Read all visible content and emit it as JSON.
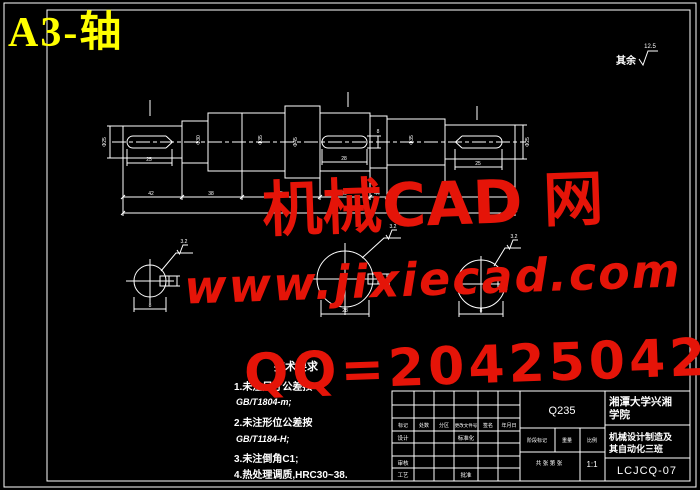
{
  "sheet": {
    "title": "A3-轴"
  },
  "colors": {
    "bg": "#000000",
    "line": "#ffffff",
    "title_yellow": "#ffff00",
    "watermark_red": "#e51408",
    "hatch_cyan": "#9fe8d8"
  },
  "surface_note": {
    "label": "其余",
    "value": "12.5"
  },
  "watermarks": {
    "brand": "机械CAD 网",
    "url": "www.jixiecad.com",
    "qq": "QQ=20425042"
  },
  "tech": {
    "title": "技术要求",
    "line1": "1.未注尺寸公差按",
    "line2": "GB/T1804-m;",
    "line3": "2.未注形位公差按",
    "line4": "GB/T1184-H;",
    "line5": "3.未注倒角C1;",
    "line6": "4.热处理调质,HRC30~38."
  },
  "dims": {
    "dia_left": "Φ25",
    "dia_s2": "Φ30",
    "dia_s3": "Φ35",
    "dia_s5": "Φ45",
    "dia_s8": "Φ35",
    "dia_right": "Φ25",
    "key_left": "25",
    "key_mid": "28",
    "key_mid_t": "8",
    "key_right": "25",
    "chain": [
      "42",
      "38",
      "85",
      "40",
      "44"
    ],
    "secA_w": "8",
    "secB_w": "28",
    "secC_w": "8",
    "rough": "3.2"
  },
  "title_block": {
    "material": "Q235",
    "school_line1": "湘潭大学兴湘",
    "school_line2": "学院",
    "course_line1": "机械设计制造及",
    "course_line2": "其自动化三班",
    "drawing_no": "LCJCQ-07",
    "scale_value": "1:1",
    "labels": {
      "mark": "标记",
      "count": "处数",
      "zone": "分区",
      "file": "更改文件号",
      "sign": "签名",
      "date": "年月日",
      "design": "设计",
      "standard": "标准化",
      "stage": "阶段标记",
      "weight": "重量",
      "scale": "比例",
      "audit": "审核",
      "craft": "工艺",
      "approve": "批准",
      "sheets": "共 张 第 张"
    }
  }
}
